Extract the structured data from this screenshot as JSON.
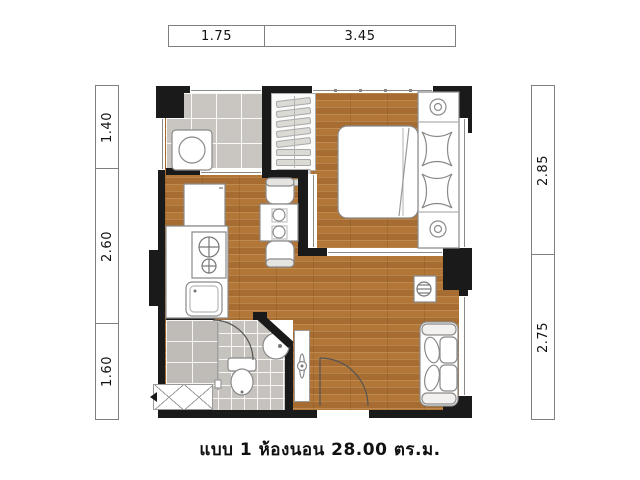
{
  "caption": "แบบ 1 ห้องนอน 28.00 ตร.ม.",
  "dims": {
    "top": [
      "1.75",
      "3.45"
    ],
    "left": [
      "1.40",
      "2.60",
      "1.60"
    ],
    "right": [
      "2.85",
      "2.75"
    ]
  },
  "icons": {
    "washing_machine": "washing-machine-icon",
    "wardrobe": "wardrobe-hanger-rail-icon",
    "bed": "double-bed-icon",
    "pillows": "butterfly-pillow-icon",
    "nightstand_lamps": "nightstand-lamp-icon",
    "refrigerator": "refrigerator-icon",
    "stove": "two-burner-stove-icon",
    "kitchen_sink": "kitchen-sink-icon",
    "dining_table": "dining-table-icon",
    "chairs": "chair-icon",
    "toilet": "toilet-icon",
    "wash_basin": "round-basin-icon",
    "shower": "shower-area-icon",
    "sofa": "sofa-icon",
    "side_lamp": "side-table-lamp-icon",
    "door_swings": "door-swing-arc-icon",
    "ac_unit": "ac-condenser-hatch-icon"
  },
  "colors": {
    "wall": "#1a1a1a",
    "wood_floor": "#b27637",
    "tile_floor": "#c9c5c0",
    "bath_tile": "#c6c2bd",
    "furniture_outline": "#8a8a8a"
  }
}
